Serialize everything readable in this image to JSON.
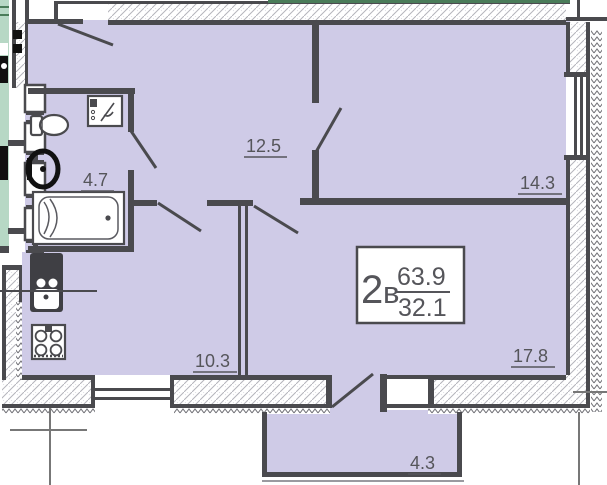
{
  "plan": {
    "unit_label_number": "2",
    "unit_label_letter": "в",
    "total_area": "63.9",
    "living_area": "32.1",
    "rooms": [
      {
        "name": "hallway",
        "area": "12.5"
      },
      {
        "name": "bedroom",
        "area": "14.3"
      },
      {
        "name": "bathroom",
        "area": "4.7"
      },
      {
        "name": "kitchen",
        "area": "10.3"
      },
      {
        "name": "living-room",
        "area": "17.8"
      },
      {
        "name": "balcony",
        "area": "4.3"
      }
    ],
    "fixtures": {
      "washing_machine": "washing-machine-icon",
      "toilet": "toilet-icon",
      "washbasin": "washbasin-icon",
      "bathtub": "bathtub-icon",
      "kitchen_sink": "kitchen-sink-icon",
      "stove": "stove-icon"
    },
    "colors": {
      "room_fill": "#cfcbe7",
      "wall": "#4a4a4e",
      "neighbor_fill": "#b7d8c5",
      "neighbor_line": "#4a7c59",
      "text": "#55555a",
      "hatch": "#b4b4bc",
      "axis": "#777777",
      "fixture_black": "#111111"
    }
  }
}
